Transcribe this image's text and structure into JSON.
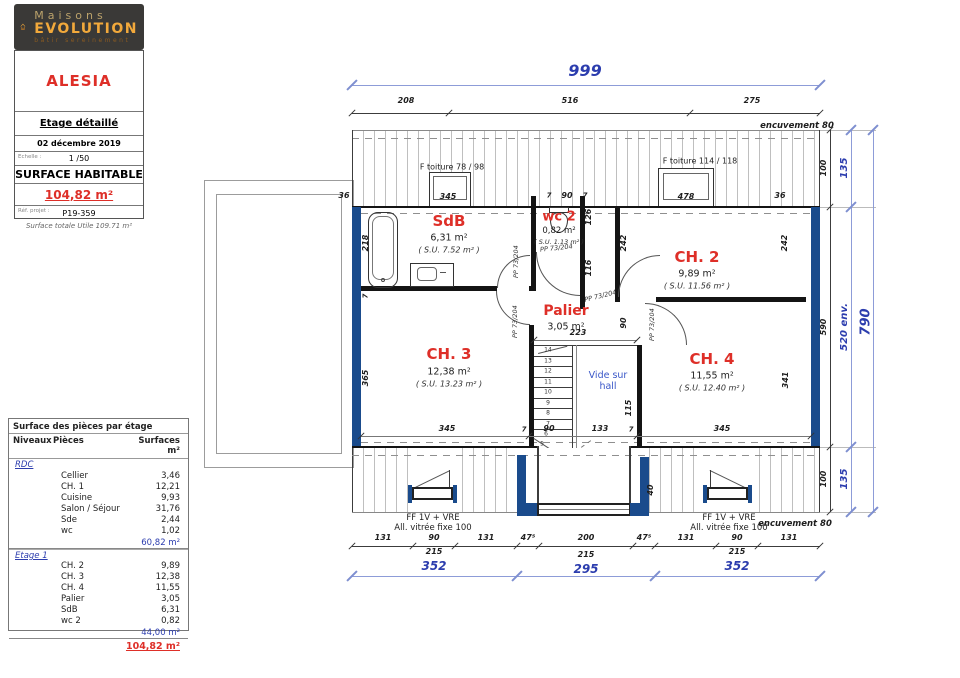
{
  "logo": {
    "brand_line1": "Maisons",
    "brand_line2": "EVOLUTION",
    "tagline": "bâtir  sereinement"
  },
  "title_block": {
    "project": "ALESIA",
    "drawing_title": "Etage détaillé",
    "date": "02 décembre 2019",
    "scale_label": "Echelle :",
    "scale_value": "1 /50",
    "surface_label": "SURFACE HABITABLE",
    "surface_value": "104,82 m²",
    "ref_label": "Réf. projet :",
    "ref_value": "P19-359",
    "footnote": "Surface totale Utile 109.71 m²"
  },
  "areas_table": {
    "title": "Surface des pièces par étage",
    "headers": {
      "level": "Niveaux",
      "room": "Pièces",
      "surface": "Surfaces m²"
    },
    "sections": [
      {
        "level": "RDC",
        "rows": [
          [
            "Cellier",
            "3,46"
          ],
          [
            "CH. 1",
            "12,21"
          ],
          [
            "Cuisine",
            "9,93"
          ],
          [
            "Salon / Séjour",
            "31,76"
          ],
          [
            "Sde",
            "2,44"
          ],
          [
            "wc",
            "1,02"
          ]
        ],
        "subtotal": "60,82 m²"
      },
      {
        "level": "Etage 1",
        "rows": [
          [
            "CH. 2",
            "9,89"
          ],
          [
            "CH. 3",
            "12,38"
          ],
          [
            "CH. 4",
            "11,55"
          ],
          [
            "Palier",
            "3,05"
          ],
          [
            "SdB",
            "6,31"
          ],
          [
            "wc 2",
            "0,82"
          ]
        ],
        "subtotal": "44,00 m²"
      }
    ],
    "total": "104,82 m²"
  },
  "rooms": {
    "sdb": {
      "name": "SdB",
      "area": "6,31 m²",
      "su": "( S.U. 7.52 m² )"
    },
    "wc2": {
      "name": "wc 2",
      "area": "0,82 m²",
      "su": "( S.U. 1.13 m² )"
    },
    "ch2": {
      "name": "CH. 2",
      "area": "9,89 m²",
      "su": "( S.U. 11.56 m² )"
    },
    "ch3": {
      "name": "CH. 3",
      "area": "12,38 m²",
      "su": "( S.U. 13.23 m² )"
    },
    "ch4": {
      "name": "CH. 4",
      "area": "11,55 m²",
      "su": "( S.U. 12.40 m² )"
    },
    "palier": {
      "name": "Palier",
      "area": "3,05 m²"
    },
    "vide": {
      "line1": "Vide sur",
      "line2": "hall"
    }
  },
  "dims": {
    "d999": "999",
    "d208": "208",
    "d516": "516",
    "d275": "275",
    "enc80": "encuvement 80",
    "d345": "345",
    "d478": "478",
    "d36": "36",
    "d7": "7",
    "d90": "90",
    "d218": "218",
    "d365": "365",
    "d126": "126",
    "d116": "116",
    "d242": "242",
    "d341": "341",
    "d115": "115",
    "d223": "223",
    "d133": "133",
    "d40": "40",
    "d131": "131",
    "d475": "47⁵",
    "d200": "200",
    "d215": "215",
    "d352": "352",
    "d295": "295",
    "d100": "100",
    "d590": "590",
    "d135": "135",
    "d520": "520 env.",
    "d790": "790"
  },
  "labels": {
    "ftoiture1": "F toiture 78 / 98",
    "ftoiture2": "F toiture 114 / 118",
    "pp": "PP 73/204",
    "ff": "FF 1V + VRE",
    "allv": "All. vitrée fixe 100"
  },
  "stairs": [
    "1",
    "2",
    "3",
    "4",
    "5",
    "6",
    "7",
    "8",
    "9",
    "10",
    "11",
    "12",
    "13",
    "14"
  ],
  "colors": {
    "wall_blue": "#1a4b8c",
    "dim_blue": "#2c3dae",
    "room_red": "#de2f28"
  }
}
